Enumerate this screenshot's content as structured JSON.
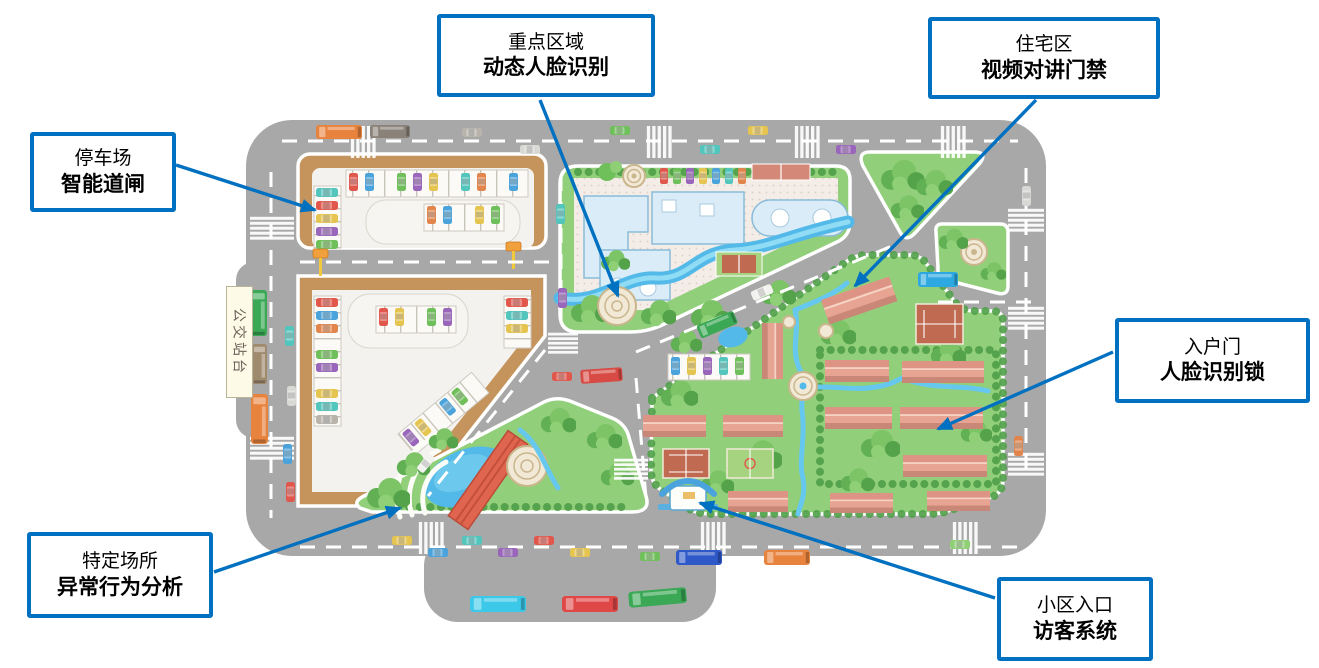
{
  "colors": {
    "callout_blue": "#0070C0",
    "road_gray": "#a8a8a8",
    "parking_tan": "#c5945c",
    "grass_green": "#92cf7b",
    "water_blue": "#52b9e9",
    "building_blue": "#d9ecf7",
    "roof_salmon": "#e2998b"
  },
  "callouts": [
    {
      "id": "parking",
      "line1": "停车场",
      "line2": "智能道闸"
    },
    {
      "id": "key-area",
      "line1": "重点区域",
      "line2": "动态人脸识别"
    },
    {
      "id": "residential",
      "line1": "住宅区",
      "line2": "视频对讲门禁"
    },
    {
      "id": "entry-door",
      "line1": "入户门",
      "line2": "人脸识别锁"
    },
    {
      "id": "special-place",
      "line1": "特定场所",
      "line2": "异常行为分析"
    },
    {
      "id": "entrance",
      "line1": "小区入口",
      "line2": "访客系统"
    }
  ],
  "map": {
    "bus_stop_label": "公交站台"
  }
}
